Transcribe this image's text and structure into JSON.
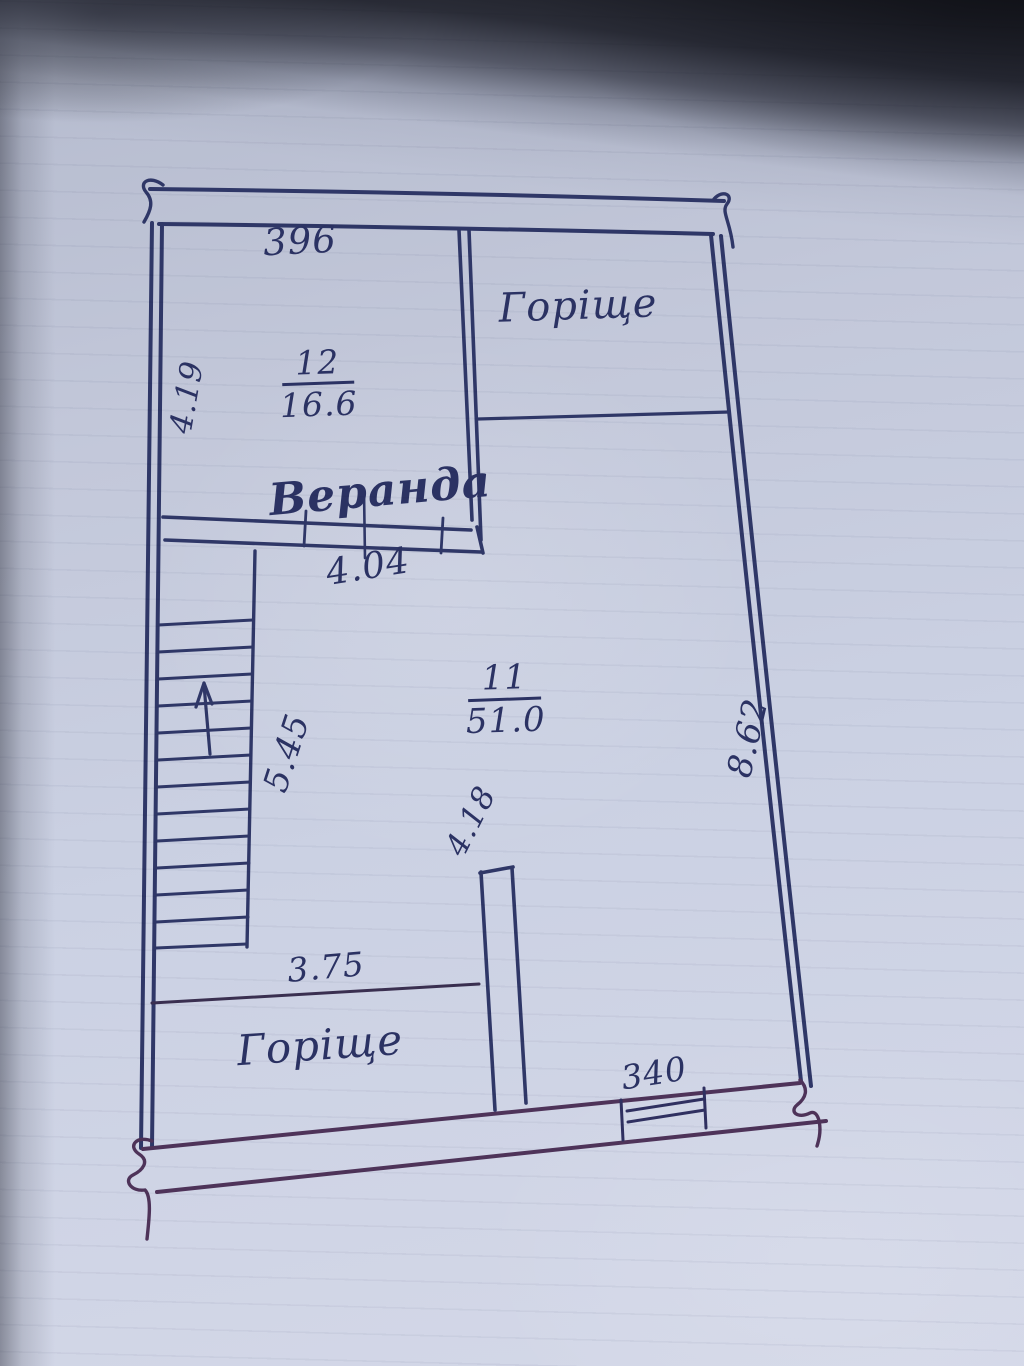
{
  "colors": {
    "ink": "#2f3767",
    "ink_bottom": "#4e3359",
    "paper": "#c9cfe1",
    "text_ink": "#2b3263"
  },
  "plan": {
    "dimensions": {
      "top": "396",
      "left": "4.19",
      "veranda_width": "4.04",
      "stairs": "5.45",
      "right": "8.62",
      "partition": "4.18",
      "bottom_left": "3.75",
      "window": "340"
    },
    "rooms": {
      "veranda": {
        "number": "12",
        "area": "16.6",
        "name": "Веранда"
      },
      "main": {
        "number": "11",
        "area": "51.0"
      },
      "attic_top": "Горіще",
      "attic_bottom": "Горіще"
    }
  }
}
